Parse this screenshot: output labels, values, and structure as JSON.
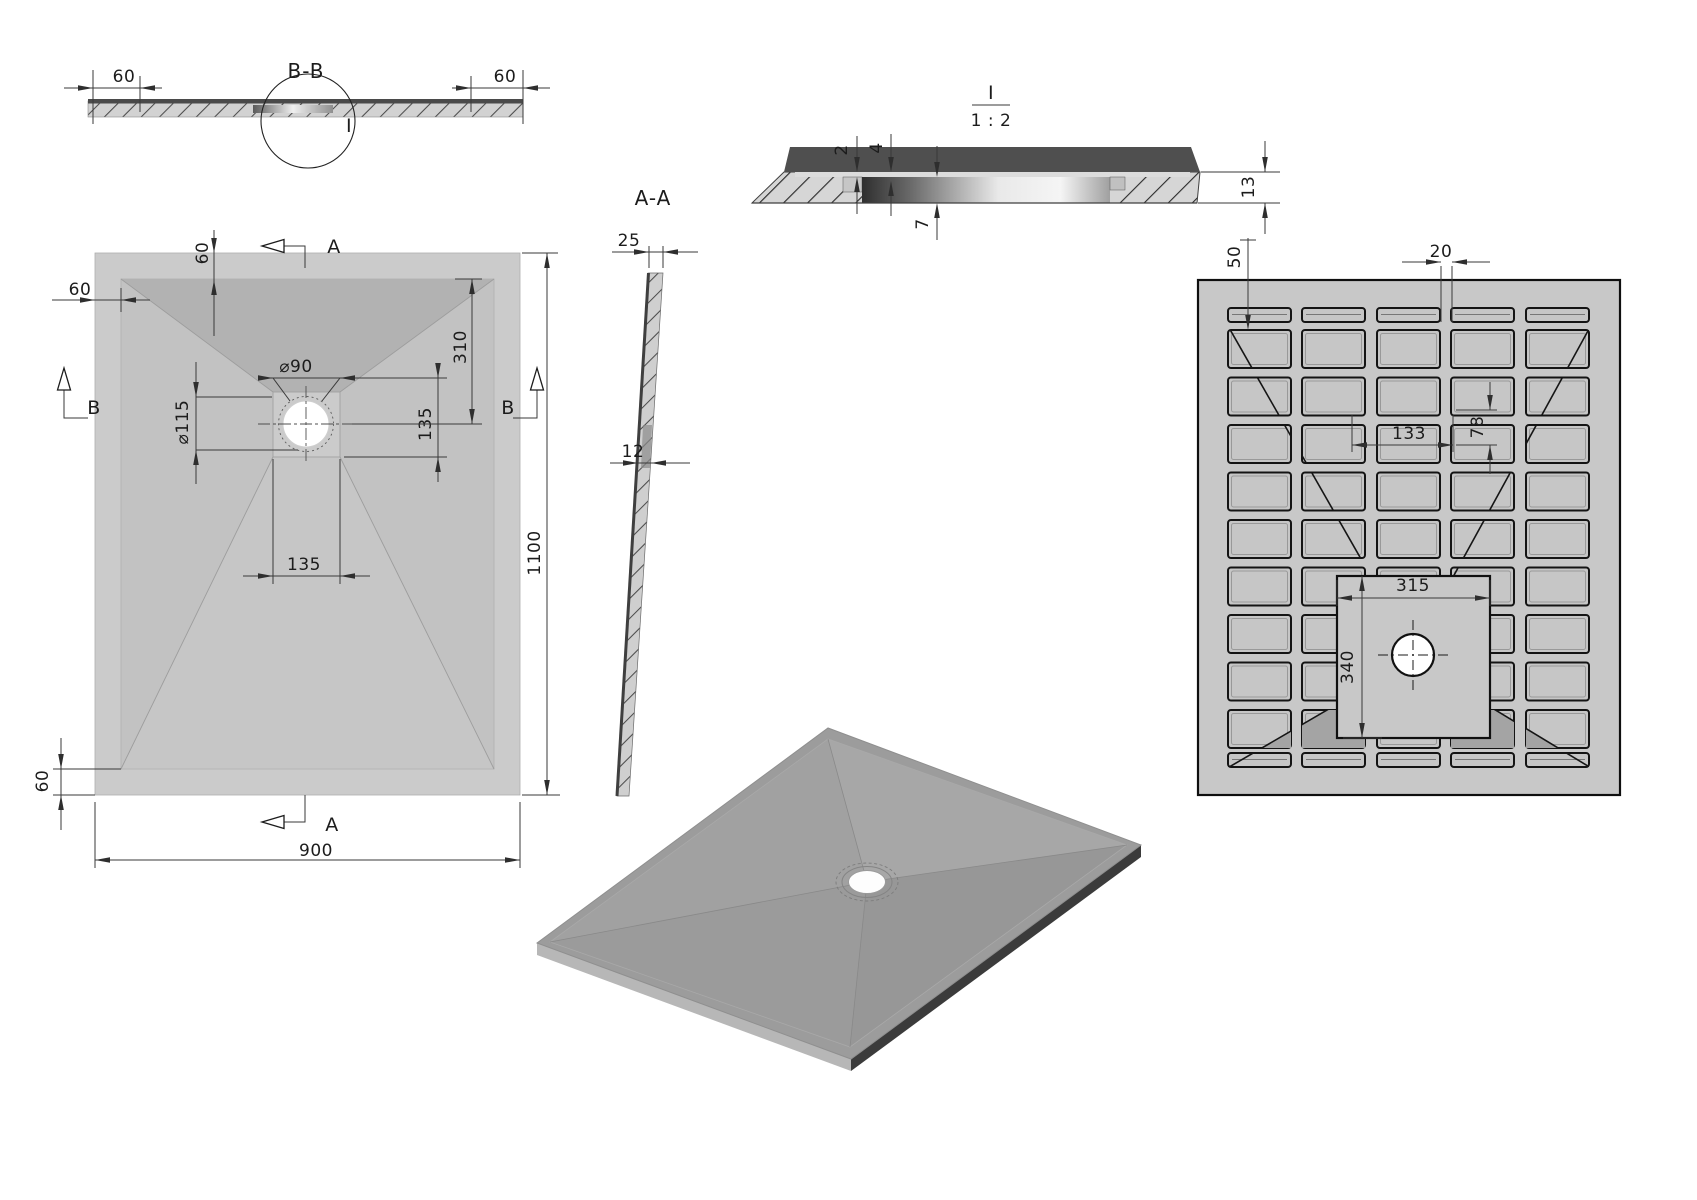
{
  "views": {
    "section_bb": {
      "title": "B-B",
      "detail_callout": "I",
      "dim_left": "60",
      "dim_right": "60"
    },
    "plan": {
      "dim_top_border": "60",
      "dim_left_border": "60",
      "dim_bottom_border": "60",
      "dim_drain_hole": "⌀90",
      "dim_drain_flange": "⌀115",
      "dim_drain_top_offset": "310",
      "dim_drain_side": "135",
      "dim_channel": "135",
      "dim_width": "900",
      "dim_length": "1100",
      "label_a": "A",
      "label_b": "B"
    },
    "section_aa": {
      "title": "A-A",
      "dim_edge": "25",
      "dim_wall": "12"
    },
    "detail_i": {
      "title": "I",
      "scale": "1 : 2",
      "dim_lip": "2",
      "dim_step": "4",
      "dim_recess": "7",
      "dim_thickness": "13"
    },
    "bottom_view": {
      "dim_edge_offset": "50",
      "dim_rib": "20",
      "dim_cell_width": "133",
      "dim_cell_height": "78",
      "dim_plate_width": "315",
      "dim_plate_height": "340"
    }
  },
  "dimensions_mm": {
    "tray_width": 900,
    "tray_length": 1100,
    "border": 60,
    "drain_hole_diameter": 90,
    "drain_flange_diameter": 115,
    "drain_offset_from_top": 310,
    "drain_side_offset": 135,
    "drain_plate": "135 x 135",
    "edge_thickness": 25,
    "wall": 12,
    "lip": 2,
    "step": 4,
    "recess_depth": 7,
    "rim_thickness": 13,
    "rib_width": 20,
    "edge_to_rib": 50,
    "cell": "133 x 78",
    "solid_plate": "315 x 340",
    "detail_scale": "1 : 2"
  },
  "colors": {
    "paper": "#ffffff",
    "plate": "#c8c8c8",
    "slope_dark": "#b2b2b2",
    "section_band": "#4f4f4f",
    "iso_side_dark": "#3b3b3b",
    "line": "#3a3a3a"
  },
  "geometry": {
    "dims": [
      {
        "s": [
          [
            64,
            88,
            162,
            88
          ],
          [
            93,
            70,
            93,
            124
          ],
          [
            140,
            76,
            140,
            112
          ]
        ],
        "a": [
          [
            93,
            88,
            0
          ],
          [
            140,
            88,
            180
          ]
        ]
      },
      {
        "s": [
          [
            452,
            88,
            550,
            88
          ],
          [
            471,
            76,
            471,
            112
          ],
          [
            523,
            70,
            523,
            124
          ]
        ],
        "a": [
          [
            471,
            88,
            0
          ],
          [
            523,
            88,
            180
          ]
        ]
      },
      {
        "s": [
          [
            214,
            230,
            214,
            336
          ]
        ],
        "a": [
          [
            214,
            253,
            90
          ],
          [
            214,
            280,
            270
          ]
        ]
      },
      {
        "s": [
          [
            52,
            300,
            150,
            300
          ],
          [
            121,
            288,
            121,
            312
          ]
        ],
        "a": [
          [
            95,
            300,
            0
          ],
          [
            121,
            300,
            180
          ]
        ]
      },
      {
        "s": [
          [
            258,
            378,
            447,
            378
          ],
          [
            273,
            378,
            290,
            401
          ],
          [
            340,
            378,
            322,
            401
          ]
        ],
        "a": [
          [
            273,
            378,
            0
          ],
          [
            340,
            378,
            180
          ]
        ]
      },
      {
        "s": [
          [
            196,
            362,
            196,
            484
          ],
          [
            196,
            397,
            272,
            397
          ],
          [
            196,
            450,
            298,
            450
          ]
        ],
        "a": [
          [
            196,
            397,
            90
          ],
          [
            196,
            450,
            270
          ]
        ]
      },
      {
        "s": [
          [
            472,
            279,
            472,
            424
          ],
          [
            455,
            279,
            482,
            279
          ],
          [
            352,
            424,
            482,
            424
          ]
        ],
        "a": [
          [
            472,
            279,
            270
          ],
          [
            472,
            424,
            90
          ]
        ]
      },
      {
        "s": [
          [
            438,
            366,
            438,
            482
          ],
          [
            344,
            457,
            447,
            457
          ]
        ],
        "a": [
          [
            438,
            378,
            90
          ],
          [
            438,
            457,
            270
          ]
        ]
      },
      {
        "s": [
          [
            243,
            576,
            370,
            576
          ],
          [
            273,
            459,
            273,
            584
          ],
          [
            340,
            459,
            340,
            584
          ]
        ],
        "a": [
          [
            273,
            576,
            0
          ],
          [
            340,
            576,
            180
          ]
        ]
      },
      {
        "s": [
          [
            547,
            253,
            547,
            795
          ],
          [
            522,
            253,
            558,
            253
          ],
          [
            522,
            795,
            560,
            795
          ]
        ],
        "a": [
          [
            547,
            253,
            270
          ],
          [
            547,
            795,
            90
          ]
        ]
      },
      {
        "s": [
          [
            95,
            860,
            520,
            860
          ],
          [
            95,
            802,
            95,
            868
          ],
          [
            520,
            802,
            520,
            868
          ]
        ],
        "a": [
          [
            95,
            860,
            180
          ],
          [
            520,
            860,
            0
          ]
        ]
      },
      {
        "s": [
          [
            61,
            738,
            61,
            830
          ],
          [
            53,
            769,
            121,
            769
          ],
          [
            53,
            795,
            95,
            795
          ]
        ],
        "a": [
          [
            61,
            769,
            90
          ],
          [
            61,
            795,
            270
          ]
        ]
      },
      {
        "s": [
          [
            612,
            252,
            698,
            252
          ],
          [
            649,
            246,
            649,
            268
          ],
          [
            663,
            246,
            663,
            268
          ]
        ],
        "a": [
          [
            649,
            252,
            0
          ],
          [
            663,
            252,
            180
          ]
        ]
      },
      {
        "s": [
          [
            610,
            463,
            690,
            463
          ]
        ],
        "a": [
          [
            638,
            463,
            0
          ],
          [
            651,
            463,
            180
          ]
        ]
      },
      {
        "s": [
          [
            857,
            136,
            857,
            168
          ],
          [
            857,
            181,
            857,
            214
          ]
        ],
        "a": [
          [
            857,
            172,
            90
          ],
          [
            857,
            177,
            270
          ]
        ]
      },
      {
        "s": [
          [
            891,
            134,
            891,
            168
          ],
          [
            891,
            185,
            891,
            216
          ]
        ],
        "a": [
          [
            891,
            172,
            90
          ],
          [
            891,
            181,
            270
          ]
        ]
      },
      {
        "s": [
          [
            937,
            146,
            937,
            173
          ],
          [
            937,
            207,
            937,
            240
          ]
        ],
        "a": [
          [
            937,
            177,
            90
          ],
          [
            937,
            203,
            270
          ]
        ]
      },
      {
        "s": [
          [
            1265,
            141,
            1265,
            172
          ],
          [
            1265,
            203,
            1265,
            234
          ],
          [
            1201,
            172,
            1280,
            172
          ],
          [
            1198,
            203,
            1280,
            203
          ]
        ],
        "a": [
          [
            1265,
            172,
            90
          ],
          [
            1265,
            203,
            270
          ]
        ]
      },
      {
        "s": [
          [
            1248,
            238,
            1248,
            316
          ],
          [
            1240,
            240,
            1256,
            240
          ]
        ],
        "a": [
          [
            1248,
            330,
            90
          ]
        ]
      },
      {
        "s": [
          [
            1402,
            262,
            1441,
            262
          ],
          [
            1452,
            262,
            1490,
            262
          ],
          [
            1441,
            266,
            1441,
            322
          ],
          [
            1452,
            266,
            1452,
            322
          ]
        ],
        "a": [
          [
            1441,
            262,
            0
          ],
          [
            1452,
            262,
            180
          ]
        ]
      },
      {
        "s": [
          [
            1352,
            445,
            1453,
            445
          ],
          [
            1352,
            415,
            1352,
            452
          ],
          [
            1453,
            415,
            1453,
            452
          ]
        ],
        "a": [
          [
            1352,
            445,
            180
          ],
          [
            1453,
            445,
            0
          ]
        ]
      },
      {
        "s": [
          [
            1490,
            382,
            1490,
            410
          ],
          [
            1490,
            445,
            1490,
            474
          ],
          [
            1456,
            410,
            1497,
            410
          ],
          [
            1456,
            445,
            1497,
            445
          ]
        ],
        "a": [
          [
            1490,
            410,
            90
          ],
          [
            1490,
            445,
            270
          ]
        ]
      },
      {
        "s": [
          [
            1337,
            598,
            1490,
            598
          ],
          [
            1337,
            580,
            1337,
            606
          ],
          [
            1490,
            580,
            1490,
            606
          ]
        ],
        "a": [
          [
            1337,
            598,
            180
          ],
          [
            1490,
            598,
            0
          ]
        ]
      },
      {
        "s": [
          [
            1362,
            576,
            1362,
            738
          ],
          [
            1343,
            738,
            1382,
            738
          ]
        ],
        "a": [
          [
            1362,
            576,
            270
          ],
          [
            1362,
            738,
            90
          ]
        ]
      }
    ],
    "grid": {
      "cols": [
        1228,
        1302,
        1377,
        1451,
        1526
      ],
      "col_w": 63,
      "slot_rows": [
        {
          "y": 308,
          "h": 14
        },
        {
          "y": 753,
          "h": 14
        }
      ],
      "rows_y": [
        330,
        377.5,
        425,
        472.5,
        520,
        567.5,
        615,
        662.5,
        710
      ],
      "row_h": 38,
      "cell_fill": "#c6c6c6"
    },
    "square": {
      "x": 1337,
      "y": 576,
      "w": 153,
      "h": 162
    },
    "diagonals": [
      [
        1212,
        298,
        1413,
        650
      ],
      [
        1606,
        298,
        1413,
        650
      ],
      [
        1212,
        777,
        1413,
        660
      ],
      [
        1606,
        777,
        1413,
        660
      ]
    ],
    "dark_tris": [
      [
        [
          1302,
          724
        ],
        [
          1365,
          688
        ],
        [
          1365,
          748
        ],
        [
          1302,
          748
        ]
      ],
      [
        [
          1514,
          721
        ],
        [
          1451,
          683
        ],
        [
          1451,
          748
        ],
        [
          1514,
          748
        ]
      ],
      [
        [
          1262,
          748
        ],
        [
          1291,
          731
        ],
        [
          1291,
          748
        ]
      ],
      [
        [
          1558,
          748
        ],
        [
          1526,
          729
        ],
        [
          1526,
          748
        ]
      ]
    ],
    "drain_bottom": {
      "cx": 1413,
      "cy": 655,
      "r": 21
    }
  }
}
